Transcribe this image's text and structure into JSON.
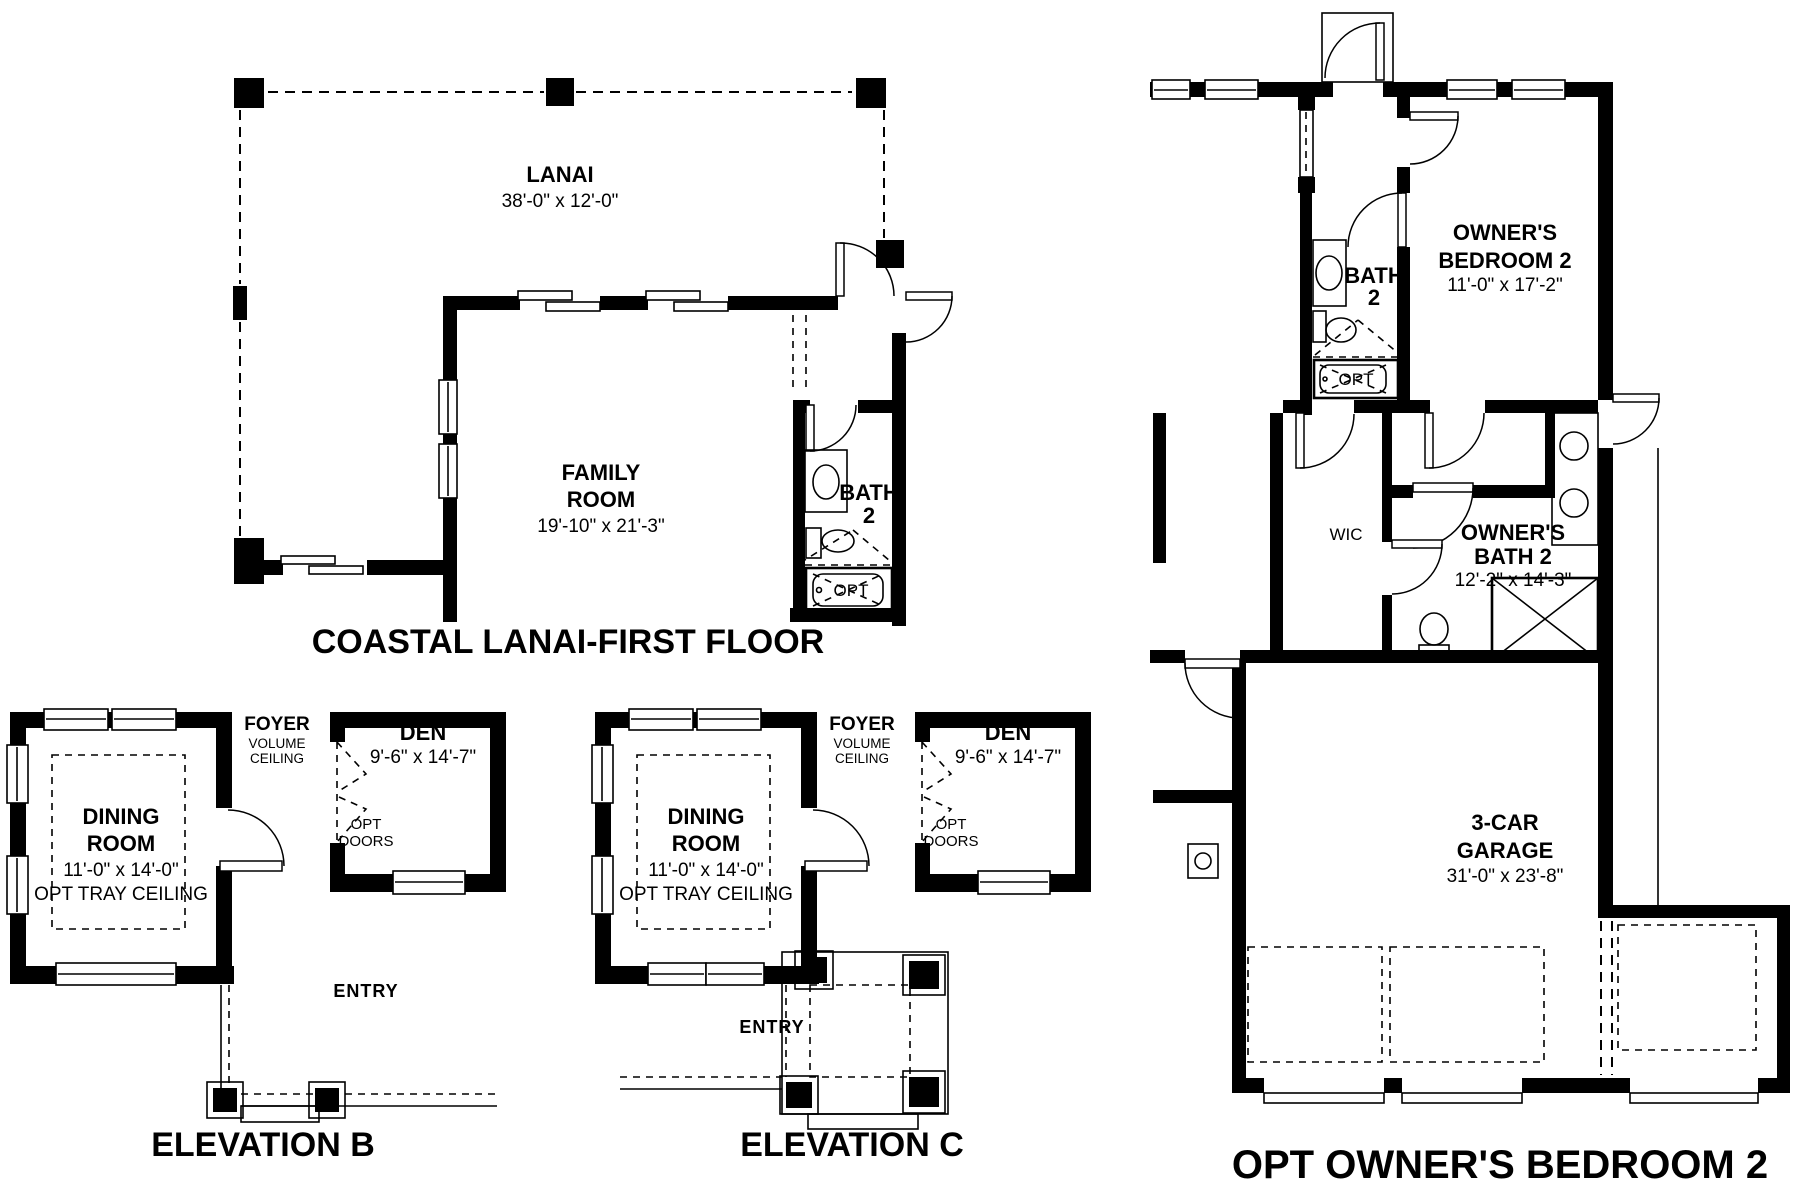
{
  "first_floor": {
    "title": "COASTAL LANAI-FIRST FLOOR",
    "lanai_name": "LANAI",
    "lanai_dims": "38'-0\" x 12'-0\"",
    "family_line1": "FAMILY",
    "family_line2": "ROOM",
    "family_dims": "19'-10\" x 21'-3\"",
    "bath_line1": "BATH",
    "bath_line2": "2",
    "opt_tub": "OPT"
  },
  "elevation_b": {
    "title": "ELEVATION B",
    "dining_line1": "DINING",
    "dining_line2": "ROOM",
    "dining_dims": "11'-0\" x 14'-0\"",
    "dining_note": "OPT TRAY CEILING",
    "foyer_name": "FOYER",
    "foyer_note1": "VOLUME",
    "foyer_note2": "CEILING",
    "den_name": "DEN",
    "den_dims": "9'-6\" x 14'-7\"",
    "opt_doors_line1": "OPT",
    "opt_doors_line2": "DOORS",
    "entry": "ENTRY"
  },
  "elevation_c": {
    "title": "ELEVATION C",
    "dining_line1": "DINING",
    "dining_line2": "ROOM",
    "dining_dims": "11'-0\" x 14'-0\"",
    "dining_note": "OPT TRAY CEILING",
    "foyer_name": "FOYER",
    "foyer_note1": "VOLUME",
    "foyer_note2": "CEILING",
    "den_name": "DEN",
    "den_dims": "9'-6\" x 14'-7\"",
    "opt_doors_line1": "OPT",
    "opt_doors_line2": "DOORS",
    "entry": "ENTRY"
  },
  "owners_suite": {
    "title": "OPT OWNER'S BEDROOM 2",
    "bedroom_line1": "OWNER'S",
    "bedroom_line2": "BEDROOM 2",
    "bedroom_dims": "11'-0\" x 17'-2\"",
    "bath2_line1": "BATH",
    "bath2_line2": "2",
    "bath2_opt_tub": "OPT",
    "wic": "WIC",
    "owners_bath_line1": "OWNER'S",
    "owners_bath_line2": "BATH 2",
    "owners_bath_dims": "12'-2\" x 14'-3\"",
    "garage_line1": "3-CAR",
    "garage_line2": "GARAGE",
    "garage_dims": "31'-0\" x 23'-8\""
  }
}
